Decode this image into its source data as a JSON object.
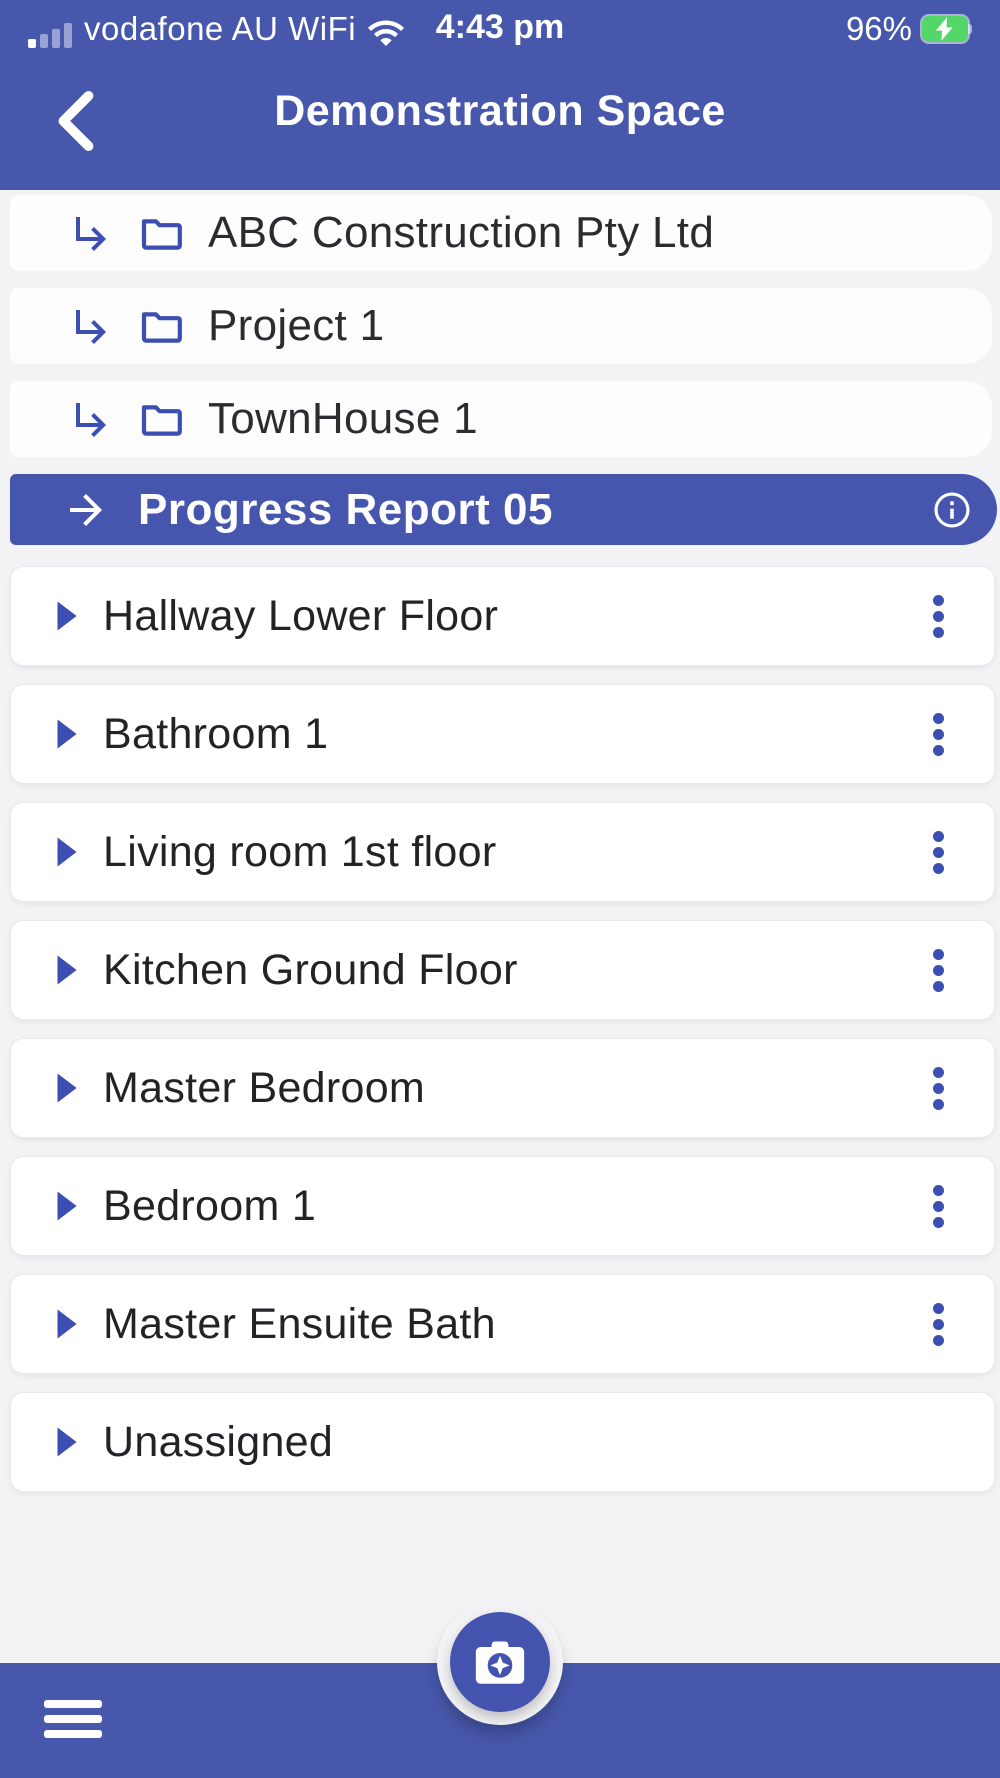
{
  "status_bar": {
    "carrier": "vodafone AU WiFi",
    "time": "4:43 pm",
    "battery_percent": "96%",
    "battery_charging": true,
    "signal_bars": 4
  },
  "nav": {
    "title": "Demonstration Space",
    "back_icon": "chevron-left"
  },
  "tree": {
    "items": [
      {
        "label": "ABC Construction Pty Ltd"
      },
      {
        "label": "Project 1"
      },
      {
        "label": "TownHouse 1"
      }
    ],
    "selected": {
      "label": "Progress Report 05"
    }
  },
  "rooms": [
    {
      "label": "Hallway Lower Floor",
      "has_menu": true
    },
    {
      "label": "Bathroom 1",
      "has_menu": true
    },
    {
      "label": "Living room 1st floor",
      "has_menu": true
    },
    {
      "label": "Kitchen Ground Floor",
      "has_menu": true
    },
    {
      "label": "Master Bedroom",
      "has_menu": true
    },
    {
      "label": "Bedroom 1",
      "has_menu": true
    },
    {
      "label": "Master Ensuite Bath",
      "has_menu": true
    },
    {
      "label": "Unassigned",
      "has_menu": false
    }
  ],
  "icons": {
    "tree_item": [
      "subdirectory-arrow-right-icon",
      "folder-icon"
    ],
    "selected_item": [
      "arrow-right-icon",
      "info-icon"
    ],
    "room_item": [
      "play-chevron-icon",
      "kebab-menu-icon"
    ],
    "footer": [
      "hamburger-menu-icon",
      "camera-sparkle-icon"
    ]
  },
  "colors": {
    "primary": "#4757ab",
    "selected_row": "#4656af",
    "accent_icon": "#3d4eb2",
    "battery_green": "#53d769",
    "page_background": "#f3f3f5",
    "card_background": "#ffffff",
    "text_dark": "#2b2b30",
    "text_light": "#ffffff"
  }
}
